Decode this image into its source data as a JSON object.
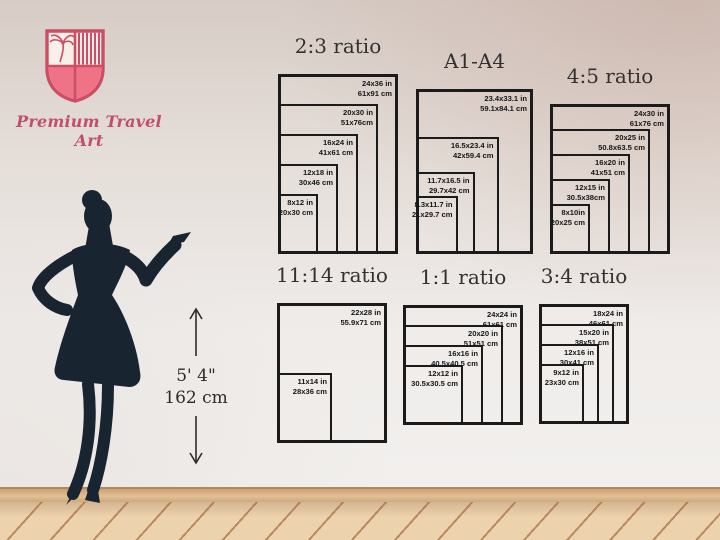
{
  "brand": {
    "name": "Premium Travel Art",
    "logo_icon": "shield-palm-crest",
    "accent": "#ce4d64",
    "accent_light": "#ef7386"
  },
  "model": {
    "height_ft": "5' 4\"",
    "height_cm": "162 cm"
  },
  "colors": {
    "wall": "#efecea",
    "wall_top": "#d7ccc6",
    "floor": "#ecd2ad",
    "floor_seam": "#b98a5f",
    "baseboard": "#e2bf95",
    "silhouette": "#18242f",
    "frame_line": "#1b1b1b",
    "title_text": "#33302e"
  },
  "charts": [
    {
      "id": "2-3",
      "title": "2:3 ratio",
      "sizes": [
        {
          "in": "24x36 in",
          "cm": "61x91 cm",
          "w": 24,
          "h": 36
        },
        {
          "in": "20x30 in",
          "cm": "51x76cm",
          "w": 20,
          "h": 30
        },
        {
          "in": "16x24 in",
          "cm": "41x61 cm",
          "w": 16,
          "h": 24
        },
        {
          "in": "12x18 in",
          "cm": "30x46 cm",
          "w": 12,
          "h": 18
        },
        {
          "in": "8x12 in",
          "cm": "20x30 cm",
          "w": 8,
          "h": 12
        }
      ]
    },
    {
      "id": "a1-a4",
      "title": "A1-A4",
      "sizes": [
        {
          "in": "23.4x33.1 in",
          "cm": "59.1x84.1 cm",
          "w": 23.4,
          "h": 33.1
        },
        {
          "in": "16.5x23.4 in",
          "cm": "42x59.4 cm",
          "w": 16.5,
          "h": 23.4
        },
        {
          "in": "11.7x16.5 in",
          "cm": "29.7x42 cm",
          "w": 11.7,
          "h": 16.5
        },
        {
          "in": "8.3x11.7 in",
          "cm": "21x29.7 cm",
          "w": 8.3,
          "h": 11.7
        }
      ]
    },
    {
      "id": "4-5",
      "title": "4:5 ratio",
      "sizes": [
        {
          "in": "24x30 in",
          "cm": "61x76 cm",
          "w": 24,
          "h": 30
        },
        {
          "in": "20x25 in",
          "cm": "50.8x63.5 cm",
          "w": 20,
          "h": 25
        },
        {
          "in": "16x20 in",
          "cm": "41x51 cm",
          "w": 16,
          "h": 20
        },
        {
          "in": "12x15 in",
          "cm": "30.5x38cm",
          "w": 12,
          "h": 15
        },
        {
          "in": "8x10in",
          "cm": "20x25 cm",
          "w": 8,
          "h": 10
        }
      ]
    },
    {
      "id": "11-14",
      "title": "11:14 ratio",
      "sizes": [
        {
          "in": "22x28 in",
          "cm": "55.9x71 cm",
          "w": 22,
          "h": 28
        },
        {
          "in": "11x14 in",
          "cm": "28x36 cm",
          "w": 11,
          "h": 14
        }
      ]
    },
    {
      "id": "1-1",
      "title": "1:1 ratio",
      "sizes": [
        {
          "in": "24x24 in",
          "cm": "61x61 cm",
          "w": 24,
          "h": 24
        },
        {
          "in": "20x20 in",
          "cm": "51x51 cm",
          "w": 20,
          "h": 20
        },
        {
          "in": "16x16 in",
          "cm": "40.5x40.5 cm",
          "w": 16,
          "h": 16
        },
        {
          "in": "12x12 in",
          "cm": "30.5x30.5 cm",
          "w": 12,
          "h": 12
        }
      ]
    },
    {
      "id": "3-4",
      "title": "3:4 ratio",
      "sizes": [
        {
          "in": "18x24 in",
          "cm": "46x61 cm",
          "w": 18,
          "h": 24
        },
        {
          "in": "15x20 in",
          "cm": "38x51 cm",
          "w": 15,
          "h": 20
        },
        {
          "in": "12x16 in",
          "cm": "30x41 cm",
          "w": 12,
          "h": 16
        },
        {
          "in": "9x12 in",
          "cm": "23x30 cm",
          "w": 9,
          "h": 12
        }
      ]
    }
  ]
}
